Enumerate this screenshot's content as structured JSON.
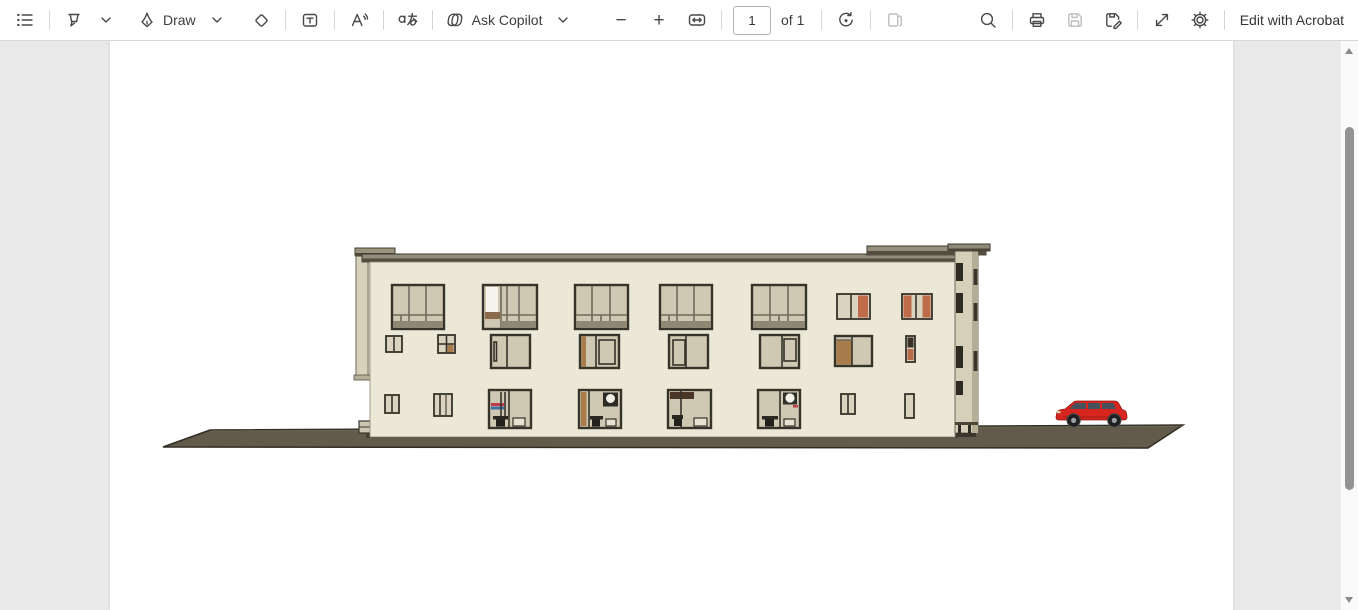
{
  "toolbar": {
    "draw_label": "Draw",
    "ask_copilot_label": "Ask Copilot",
    "translate_glyph": "a",
    "zoom_out_glyph": "−",
    "zoom_in_glyph": "+",
    "page_input_value": "1",
    "page_count_label": "of 1",
    "edit_with_acrobat_label": "Edit with Acrobat"
  },
  "document": {
    "viewer_background": "#e9e9e9",
    "page_background": "#ffffff",
    "drawing": {
      "subject": "building-side-elevation-with-red-car",
      "building_color": "#ebe8d7",
      "glass_color": "#cfc8b3",
      "frame_color": "#35332a",
      "accent_orange": "#bf6c4a",
      "wood_color": "#a97c4b",
      "roof_top_color": "#938d7b",
      "roof_dark_color": "#524d3f",
      "side_color": "#d8d2bd",
      "ground_color": "#625b4b",
      "car_color": "#d8251f"
    }
  }
}
